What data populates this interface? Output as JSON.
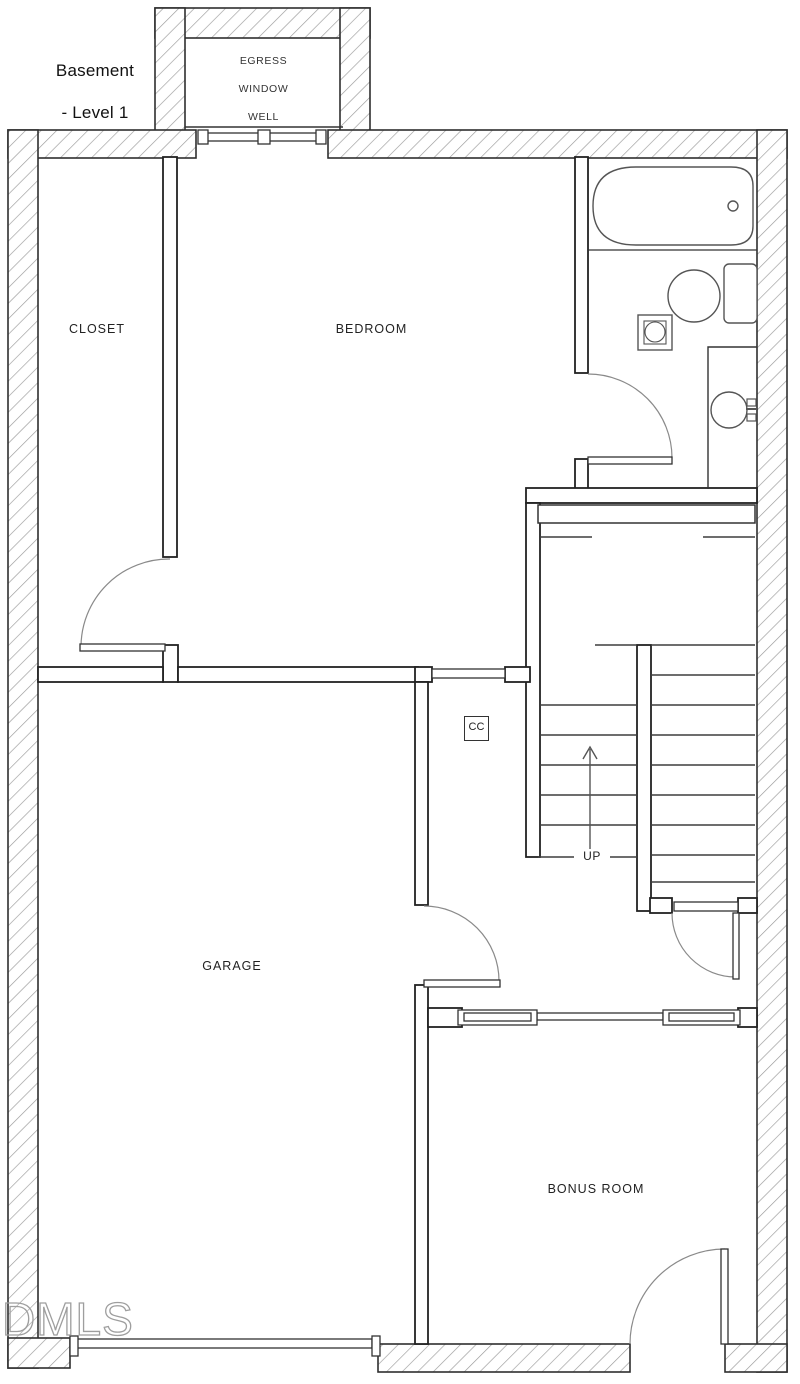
{
  "plan": {
    "title": {
      "line1": "Basement",
      "line2": "- Level 1"
    },
    "rooms": {
      "closet": "CLOSET",
      "bedroom": "BEDROOM",
      "garage": "GARAGE",
      "bonus_room": "BONUS ROOM"
    },
    "annotations": {
      "egress_line1": "EGRESS",
      "egress_line2": "WINDOW",
      "egress_line3": "WELL",
      "stairs_direction": "UP",
      "cc_marker": "CC"
    },
    "watermark": "DMLS",
    "colors": {
      "wall_outline": "#2f2f2f",
      "hatch_line": "#9a9a9a",
      "interior_line": "#222222",
      "door_arc": "#8a8a8a",
      "label_text": "#222222",
      "watermark_outline": "#9e9e9e",
      "background": "#ffffff"
    }
  }
}
